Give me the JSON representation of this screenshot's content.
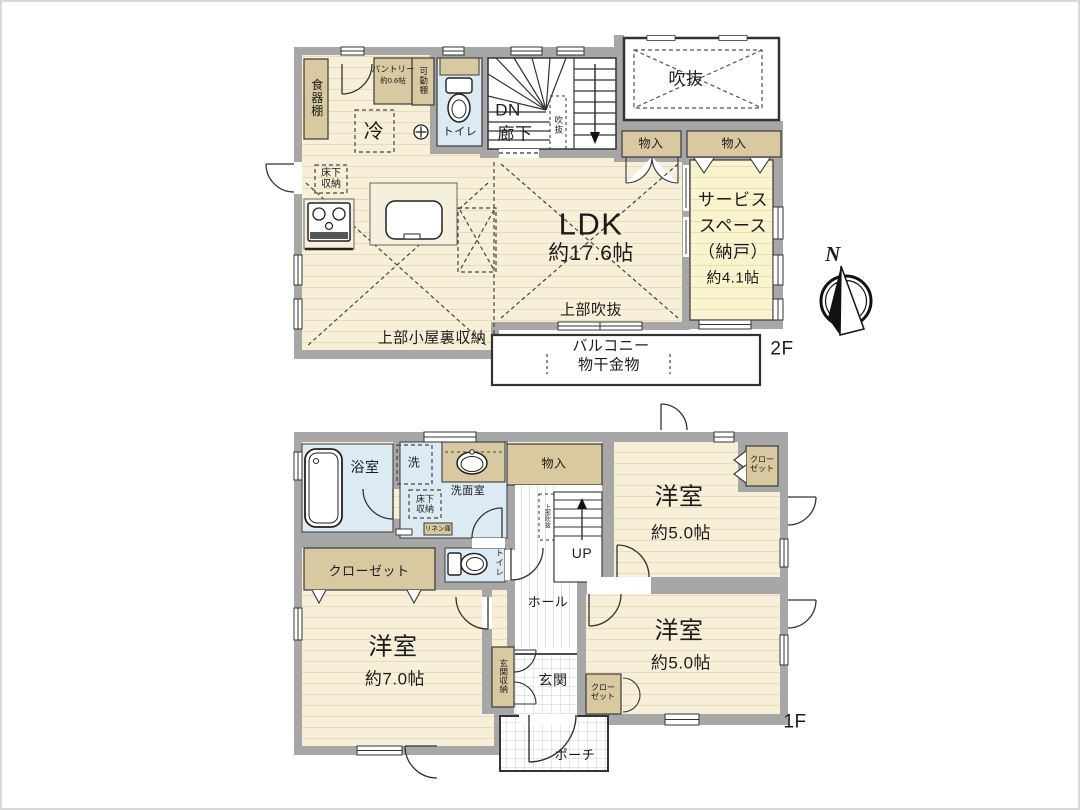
{
  "meta": {
    "floor2_label": "2F",
    "floor1_label": "1F",
    "compass_north": "N"
  },
  "floor2": {
    "dish_shelf": "食器棚",
    "pantry": "パントリー",
    "pantry_size": "約0.6帖",
    "movable_shelf": "可動棚",
    "fridge": "冷",
    "toilet": "トイレ",
    "dn": "DN",
    "corridor": "廊下",
    "stair_void": "吹抜",
    "void": "吹抜",
    "storage_a": "物入",
    "storage_b": "物入",
    "underfloor": "床下収納",
    "ldk": "LDK",
    "ldk_size": "約17.6帖",
    "service_1": "サービス",
    "service_2": "スペース",
    "service_3": "（納戸）",
    "service_size": "約4.1帖",
    "upper_void": "上部吹抜",
    "attic": "上部小屋裏収納",
    "balcony_1": "バルコニー",
    "balcony_2": "物干金物"
  },
  "floor1": {
    "bathroom": "浴室",
    "washer": "洗",
    "washroom": "洗面室",
    "underfloor": "床下収納",
    "linen": "リネン庫",
    "storage": "物入",
    "up": "UP",
    "stair_upper_void": "上部吹抜",
    "hall": "ホール",
    "toilet": "トイレ",
    "closet_main": "クローゼット",
    "room7": "洋室",
    "room7_size": "約7.0帖",
    "entry_storage": "玄関収納",
    "entry": "玄関",
    "closet_small": "クローゼット",
    "room5a": "洋室",
    "room5a_size": "約5.0帖",
    "closet_5a": "クローゼット",
    "room5b": "洋室",
    "room5b_size": "約5.0帖",
    "porch": "ポーチ"
  },
  "colors": {
    "wall": "#a7a7a7",
    "floor_cream": "#f8efd9",
    "floor_pale_yellow": "#faf3d0",
    "water_blue": "#dcebf3",
    "storage_tan": "#d9c9a1",
    "line_dark": "#333333"
  }
}
